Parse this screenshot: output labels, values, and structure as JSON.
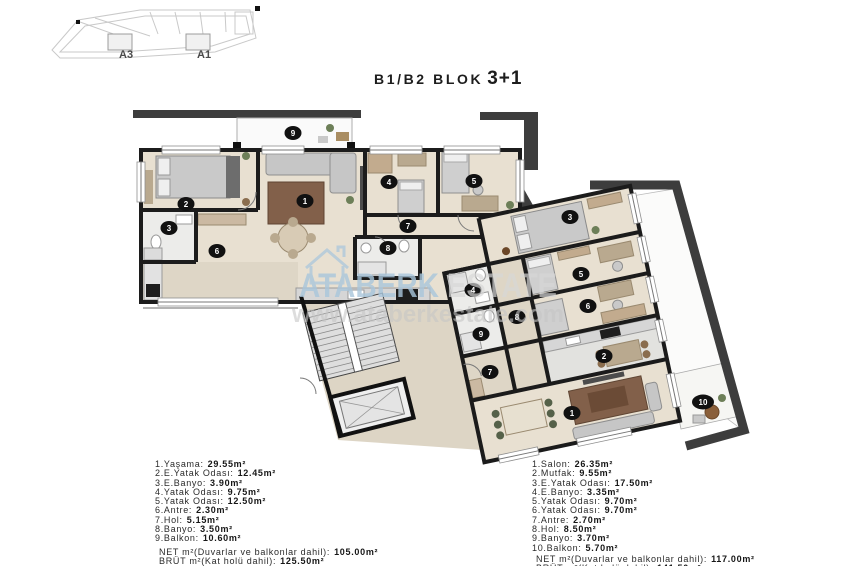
{
  "title": {
    "block": "B1/B2 BLOK",
    "type": "3+1"
  },
  "site_plan": {
    "labels": [
      "A3",
      "A1"
    ]
  },
  "watermark": {
    "brand_primary": "ATABERK",
    "brand_secondary": "ESTATE",
    "url": "www.ataberkestate.com"
  },
  "plan": {
    "left_badges": [
      "1",
      "2",
      "3",
      "4",
      "5",
      "6",
      "7",
      "8",
      "9"
    ],
    "right_badges": [
      "1",
      "2",
      "3",
      "4",
      "5",
      "6",
      "7",
      "8",
      "9",
      "10"
    ],
    "colors": {
      "wall": "#1c1c1c",
      "floor_wood": "#e8e0d1",
      "floor_tile": "#ececea",
      "corridor": "#ddd5c5",
      "dark_band": "#3d3d3d",
      "watermark_blue": "#a9c6dc",
      "badge": "#111111"
    }
  },
  "legend_left": {
    "items": [
      {
        "name": "1.Yaşama:",
        "value": "29.55m²"
      },
      {
        "name": "2.E.Yatak Odası:",
        "value": "12.45m²"
      },
      {
        "name": "3.E.Banyo:",
        "value": "3.90m²"
      },
      {
        "name": "4.Yatak Odası:",
        "value": "9.75m²"
      },
      {
        "name": "5.Yatak Odası:",
        "value": "12.50m²"
      },
      {
        "name": "6.Antre:",
        "value": "2.30m²"
      },
      {
        "name": "7.Hol:",
        "value": "5.15m²"
      },
      {
        "name": "8.Banyo:",
        "value": "3.50m²"
      },
      {
        "name": "9.Balkon:",
        "value": "10.60m²"
      }
    ],
    "net": {
      "name": "NET m²(Duvarlar ve balkonlar dahil):",
      "value": "105.00m²"
    },
    "brut": {
      "name": "BRÜT m²(Kat holü dahil):",
      "value": "125.50m²"
    }
  },
  "legend_right": {
    "items": [
      {
        "name": "1.Salon:",
        "value": "26.35m²"
      },
      {
        "name": "2.Mutfak:",
        "value": "9.55m²"
      },
      {
        "name": "3.E.Yatak Odası:",
        "value": "17.50m²"
      },
      {
        "name": "4.E.Banyo:",
        "value": "3.35m²"
      },
      {
        "name": "5.Yatak Odası:",
        "value": "9.70m²"
      },
      {
        "name": "6.Yatak Odası:",
        "value": "9.70m²"
      },
      {
        "name": "7.Antre:",
        "value": "2.70m²"
      },
      {
        "name": "8.Hol:",
        "value": "8.50m²"
      },
      {
        "name": "9.Banyo:",
        "value": "3.70m²"
      },
      {
        "name": "10.Balkon:",
        "value": "5.70m²"
      }
    ],
    "net": {
      "name": "NET m²(Duvarlar ve balkonlar dahil):",
      "value": "117.00m²"
    },
    "brut": {
      "name": "BRÜT m²(Kat holü dahil):",
      "value": "141.50m²"
    }
  }
}
